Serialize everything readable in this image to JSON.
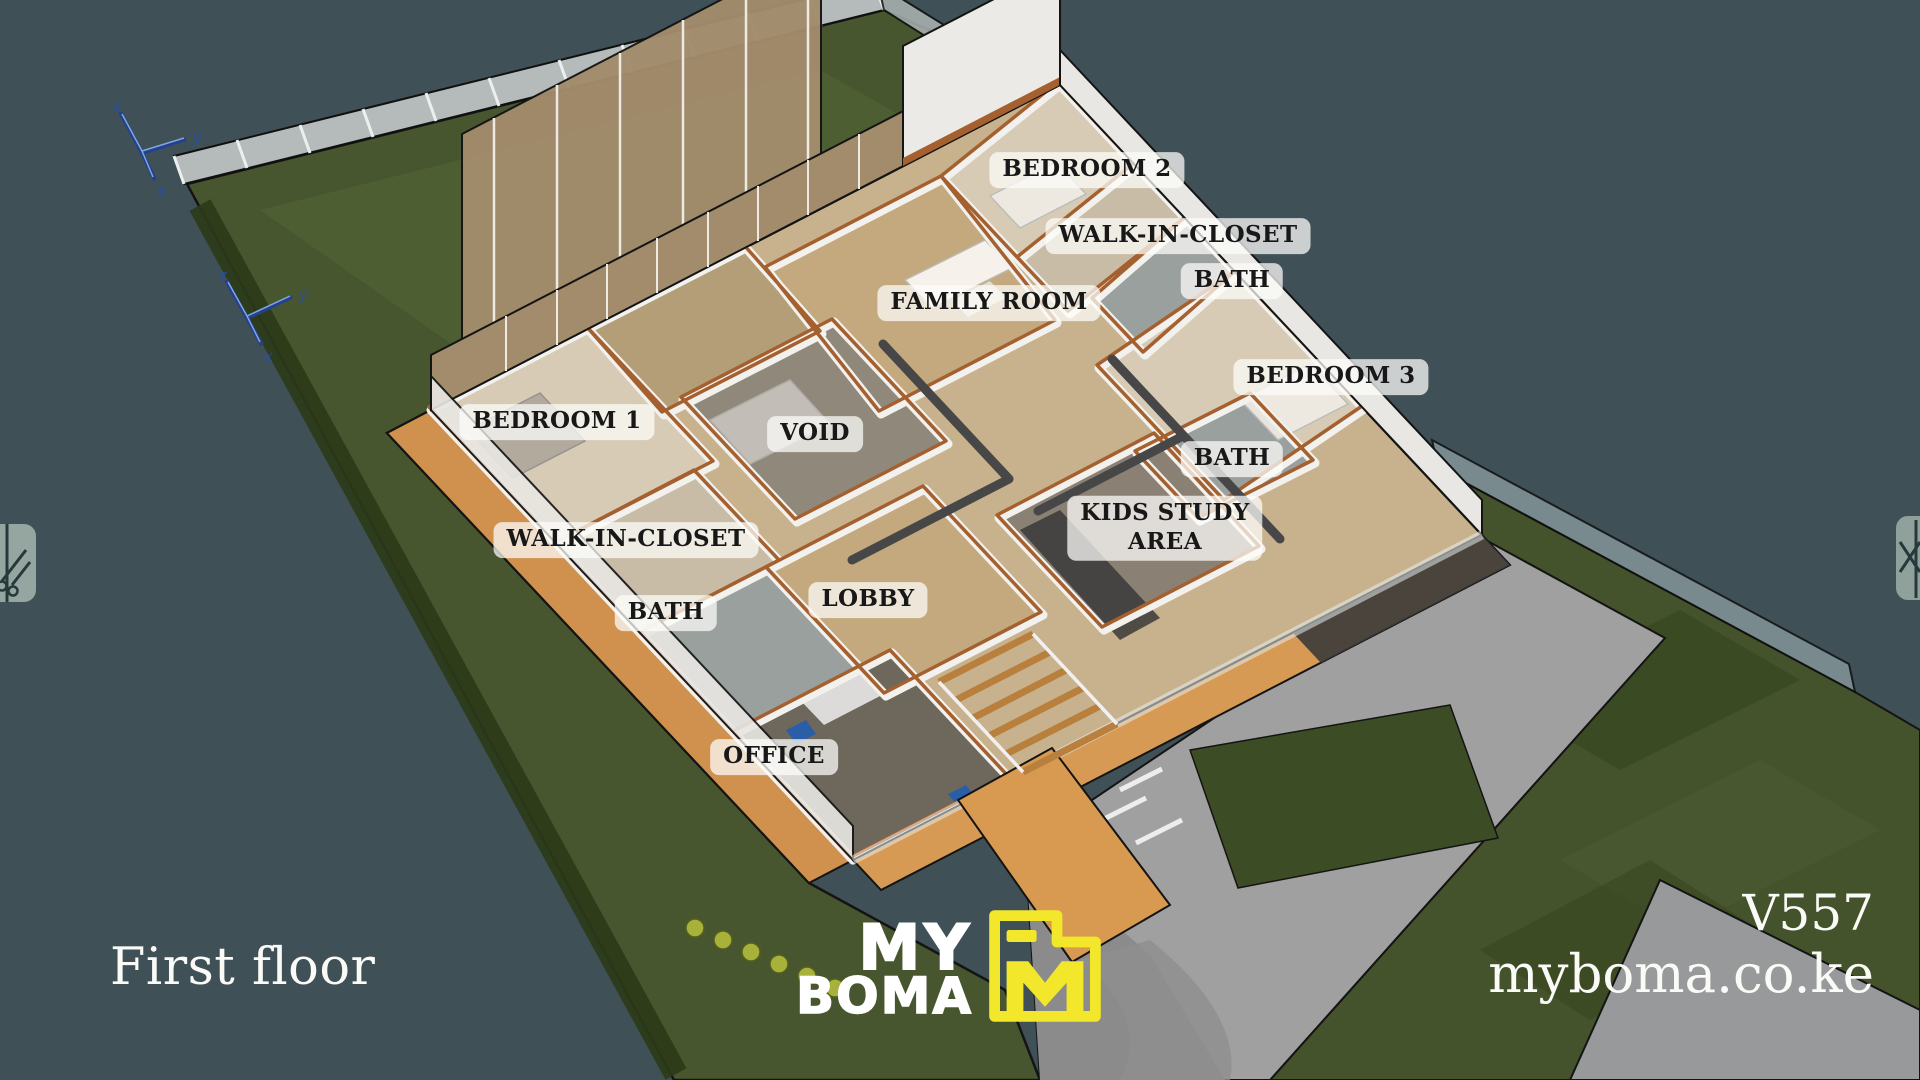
{
  "overlay": {
    "floor_title": "First floor",
    "plan_code": "V557",
    "website": "myboma.co.ke"
  },
  "logo": {
    "word1": "MY",
    "word2": "BOMA",
    "icon": "m-building-icon",
    "yellow": "#F2E72B"
  },
  "rooms": [
    {
      "label": "BEDROOM 2",
      "cx": 1087,
      "cy": 170
    },
    {
      "label": "WALK-IN-CLOSET",
      "cx": 1178,
      "cy": 236
    },
    {
      "label": "BATH",
      "cx": 1232,
      "cy": 281
    },
    {
      "label": "FAMILY ROOM",
      "cx": 989,
      "cy": 303
    },
    {
      "label": "BEDROOM 3",
      "cx": 1331,
      "cy": 377
    },
    {
      "label": "BATH",
      "cx": 1232,
      "cy": 459
    },
    {
      "label": "KIDS STUDY\nAREA",
      "cx": 1165,
      "cy": 528
    },
    {
      "label": "VOID",
      "cx": 815,
      "cy": 434
    },
    {
      "label": "BEDROOM 1",
      "cx": 557,
      "cy": 422
    },
    {
      "label": "WALK-IN-CLOSET",
      "cx": 626,
      "cy": 540
    },
    {
      "label": "BATH",
      "cx": 666,
      "cy": 613
    },
    {
      "label": "LOBBY",
      "cx": 868,
      "cy": 600
    },
    {
      "label": "OFFICE",
      "cx": 774,
      "cy": 757
    }
  ],
  "axes": {
    "x": "x",
    "y": "y",
    "z": "z"
  },
  "colors": {
    "background": "#3F5057",
    "lawn": "#47562E",
    "paving": "#9E9E9E",
    "wall_cap": "#A5602F",
    "deck": "#D69A54",
    "label_bg": "rgba(252,252,250,0.74)",
    "label_text": "#181818",
    "axis_blue": "#2A4FA0"
  }
}
